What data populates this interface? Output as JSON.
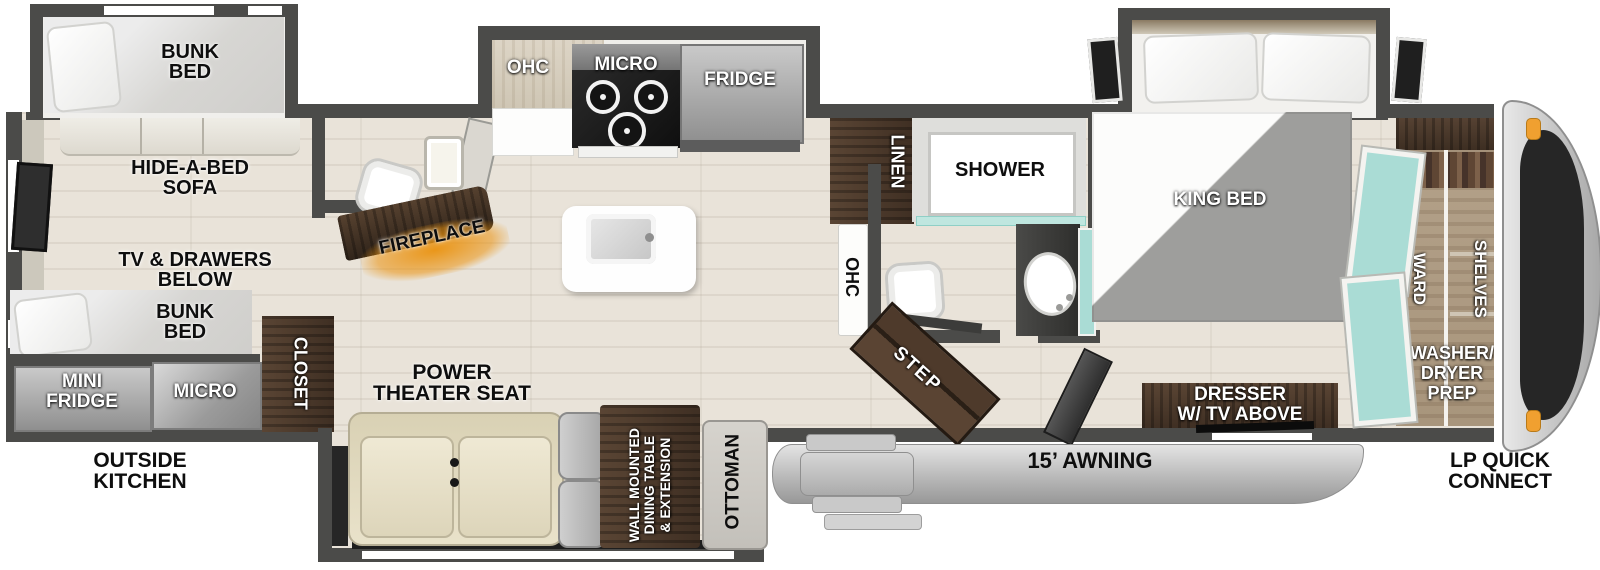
{
  "colors": {
    "wall": "#4b4b49",
    "floor_wood": "#e9e3d9",
    "dark_wood": "#4a392c",
    "fireplace_glow": "#e8900f",
    "teal_mirror": "#aadcd5",
    "appliance_gray": "#8f8f8f",
    "awning_gray": "#c6c6c6",
    "seat_cream": "#e7e0c7",
    "windshield": "#262626",
    "marker_light_orange": "#f0a030"
  },
  "labels": {
    "bunk_top": [
      "BUNK",
      "BED"
    ],
    "hide_a_bed": [
      "HIDE-A-BED",
      "SOFA"
    ],
    "tv_drawers": [
      "TV & DRAWERS",
      "BELOW"
    ],
    "bunk_bottom": [
      "BUNK",
      "BED"
    ],
    "mini_fridge": [
      "MINI",
      "FRIDGE"
    ],
    "micro_outside": "MICRO",
    "closet": "CLOSET",
    "outside_kitchen": [
      "OUTSIDE",
      "KITCHEN"
    ],
    "fireplace": "FIREPLACE",
    "ohc_kitchen": "OHC",
    "micro_kitchen": "MICRO",
    "fridge": "FRIDGE",
    "power_theater_seat": [
      "POWER",
      "THEATER SEAT"
    ],
    "dining_table": [
      "WALL MOUNTED",
      "DINING TABLE",
      "& EXTENSION"
    ],
    "ottoman": "OTTOMAN",
    "linen": "LINEN",
    "shower": "SHOWER",
    "ohc_bath": "OHC",
    "step": "STEP",
    "king_bed": "KING BED",
    "dresser": [
      "DRESSER",
      "W/ TV ABOVE"
    ],
    "ward": "WARD",
    "shelves": "SHELVES",
    "washer_dryer": [
      "WASHER/",
      "DRYER",
      "PREP"
    ],
    "awning": "15’ AWNING",
    "lp_quick_connect": [
      "LP QUICK",
      "CONNECT"
    ]
  }
}
